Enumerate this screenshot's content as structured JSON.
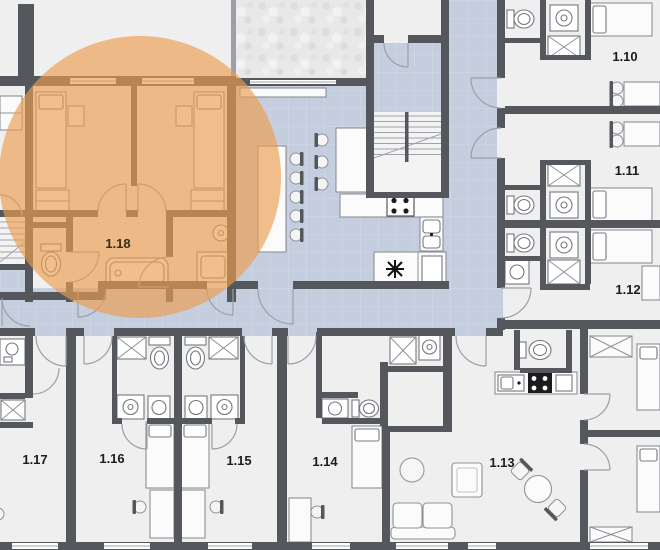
{
  "plan": {
    "selected_unit": "1.18",
    "units": [
      {
        "id": "1.10",
        "label": "1.10"
      },
      {
        "id": "1.11",
        "label": "1.11"
      },
      {
        "id": "1.12",
        "label": "1.12"
      },
      {
        "id": "1.13",
        "label": "1.13"
      },
      {
        "id": "1.14",
        "label": "1.14"
      },
      {
        "id": "1.15",
        "label": "1.15"
      },
      {
        "id": "1.16",
        "label": "1.16"
      },
      {
        "id": "1.17",
        "label": "1.17"
      },
      {
        "id": "1.18",
        "label": "1.18"
      }
    ],
    "colors": {
      "wall": "#54575c",
      "room": "#efefef",
      "corridor": "#c5cedf",
      "terrace": "#e8e8e8",
      "highlight": "#ec9d4f",
      "label": "#1c1c1e"
    }
  }
}
